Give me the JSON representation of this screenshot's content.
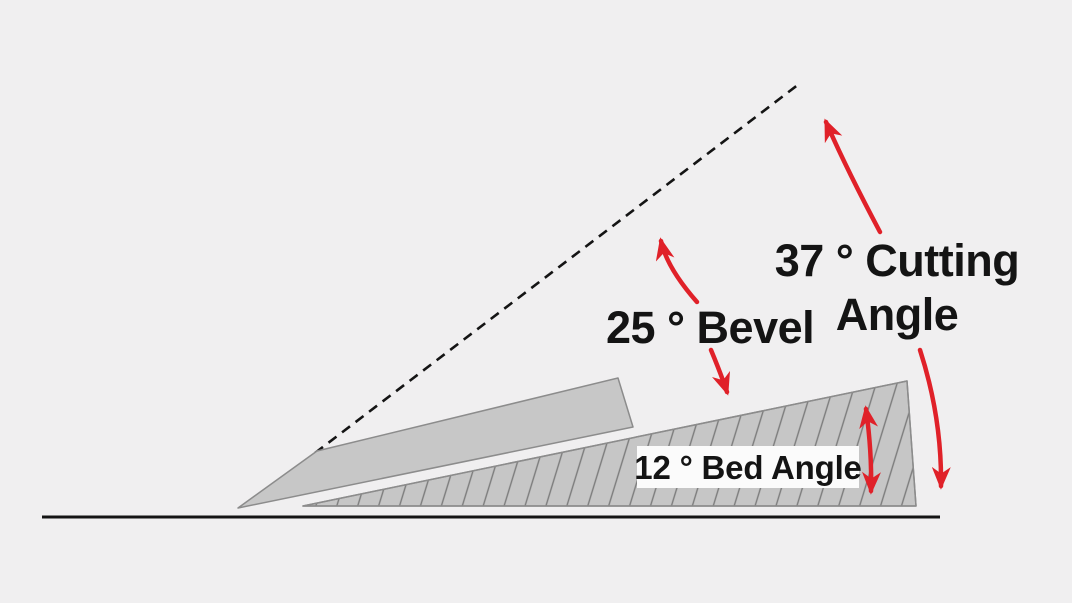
{
  "diagram": {
    "type": "blade-sharpening-angle-diagram",
    "labels": {
      "cutting_angle": {
        "line1": "37 ° Cutting",
        "line2": "Angle",
        "angle_deg": 37
      },
      "bevel": {
        "text": "25 ° Bevel",
        "angle_deg": 25
      },
      "bed_angle": {
        "text": "12 ° Bed Angle",
        "angle_deg": 12
      }
    },
    "colors": {
      "background": "#f0eff0",
      "blade_fill": "#c7c7c7",
      "bed_fill": "#c6c6c6",
      "outline": "#8c8c8c",
      "hatch_line": "#7b7b7b",
      "arrow_red": "#e02129",
      "text": "#141414",
      "baseline": "#141414",
      "label_box": "#fbfbfb"
    }
  }
}
